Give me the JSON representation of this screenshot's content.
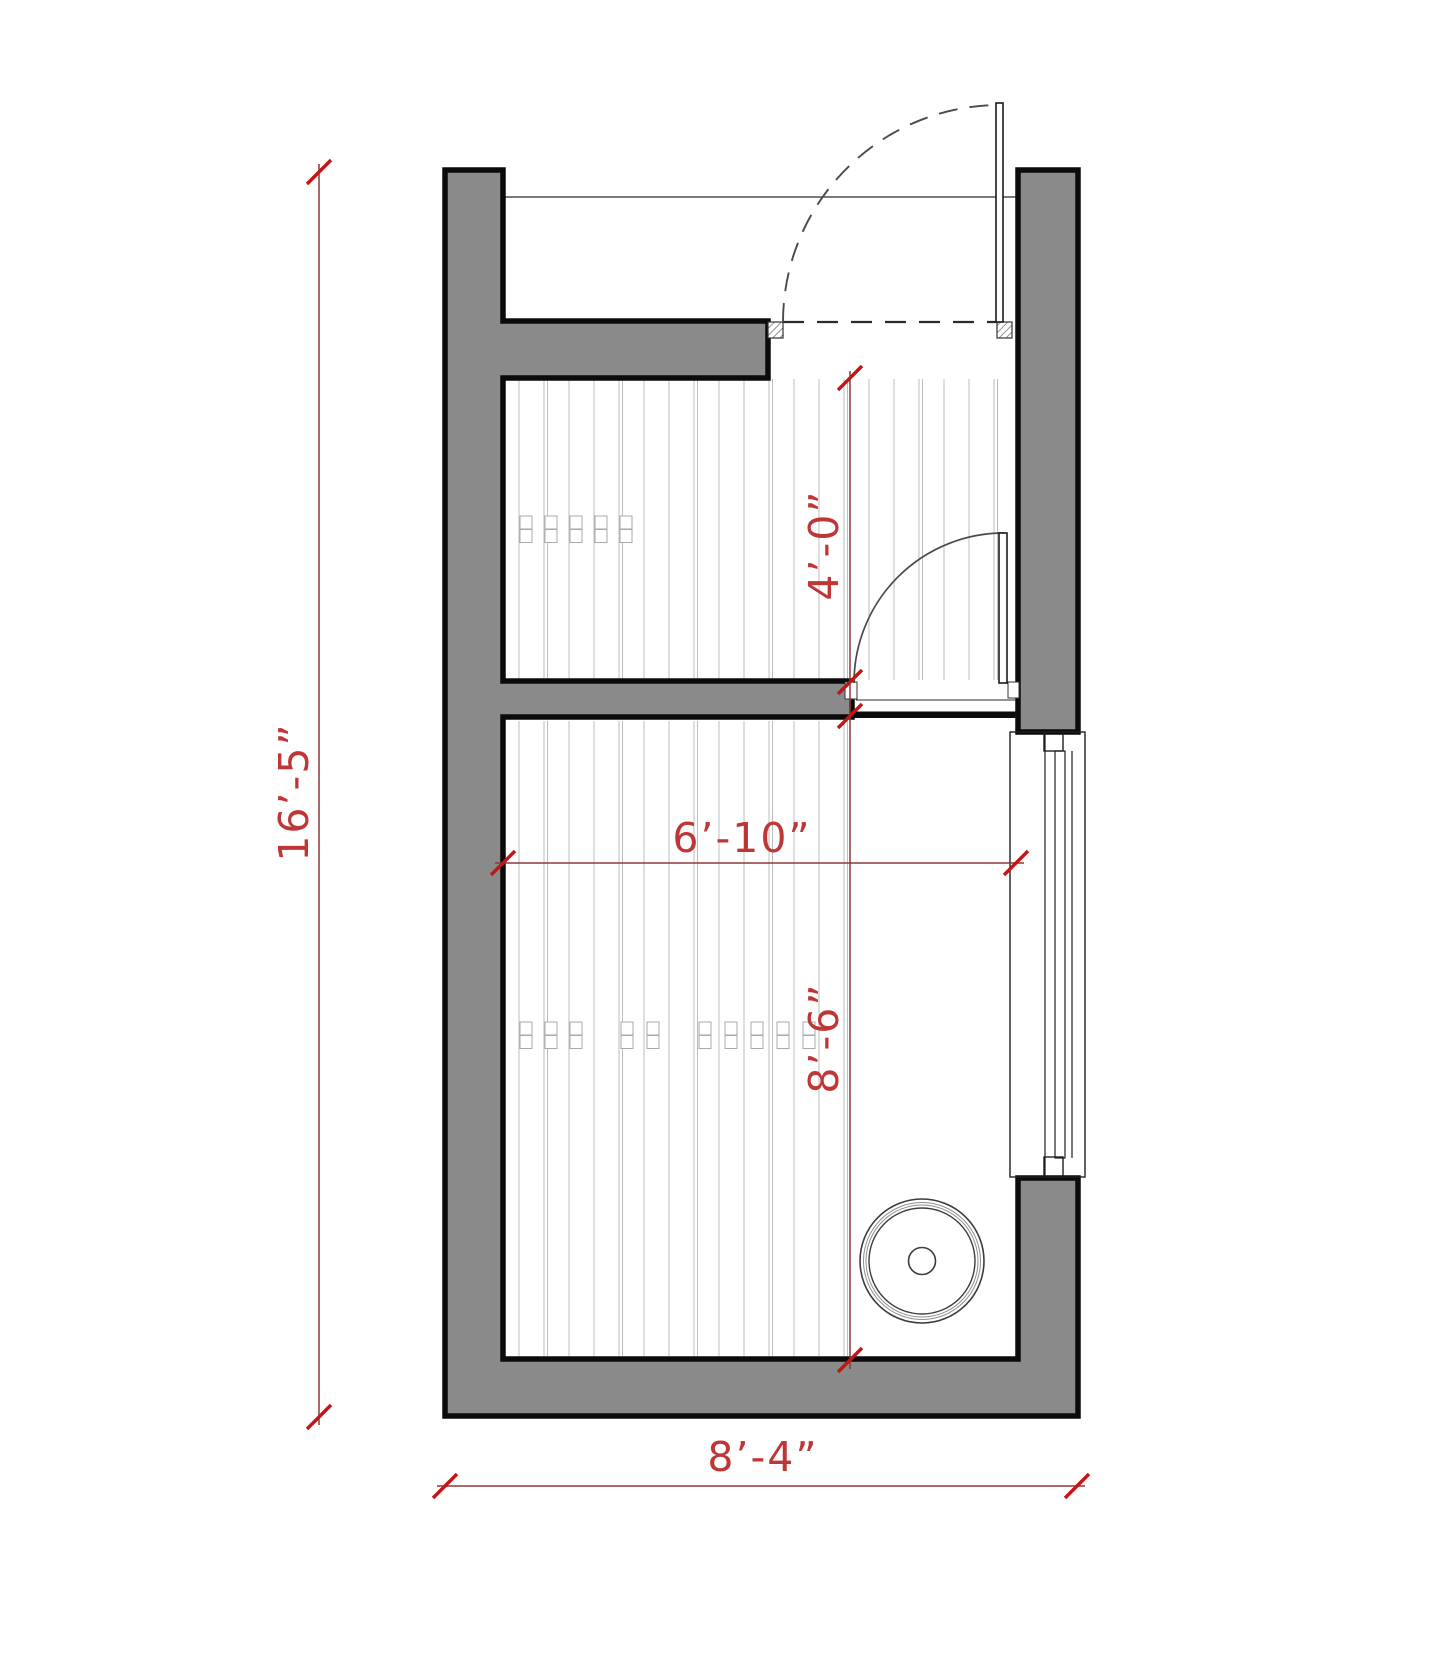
{
  "drawing": {
    "type": "architectural-floor-plan",
    "dimensions": {
      "overall_height": "16’-5”",
      "overall_width": "8’-4”",
      "upper_room_depth": "4’-0”",
      "interior_width": "6’-10”",
      "lower_room_depth": "8’-6”"
    },
    "colors": {
      "background": "#ffffff",
      "wall_fill": "#8a8a8a",
      "wall_outline": "#0b0b0b",
      "detail_line": "#2b2b2b",
      "door_swing": "#4a4a4a",
      "floor_hatch": "#bcbcbc",
      "dimension_line": "#8c3838",
      "dimension_tick": "#c41414",
      "dimension_text": "#bf3636"
    },
    "hatch": {
      "spacing": 25,
      "pair_offset": 3.5,
      "upper_region": {
        "x1": 508,
        "y1": 379,
        "x2": 1006,
        "y2": 680
      },
      "lower_region": {
        "x1": 508,
        "y1": 721,
        "x2": 847,
        "y2": 1356
      },
      "upper_joints": {
        "y": 516,
        "xs": [
          520,
          545,
          570,
          595,
          620
        ]
      },
      "lower_joints": {
        "y": 1022,
        "xs": [
          520,
          545,
          570,
          621,
          647,
          699,
          725,
          751,
          777,
          803
        ]
      }
    }
  }
}
